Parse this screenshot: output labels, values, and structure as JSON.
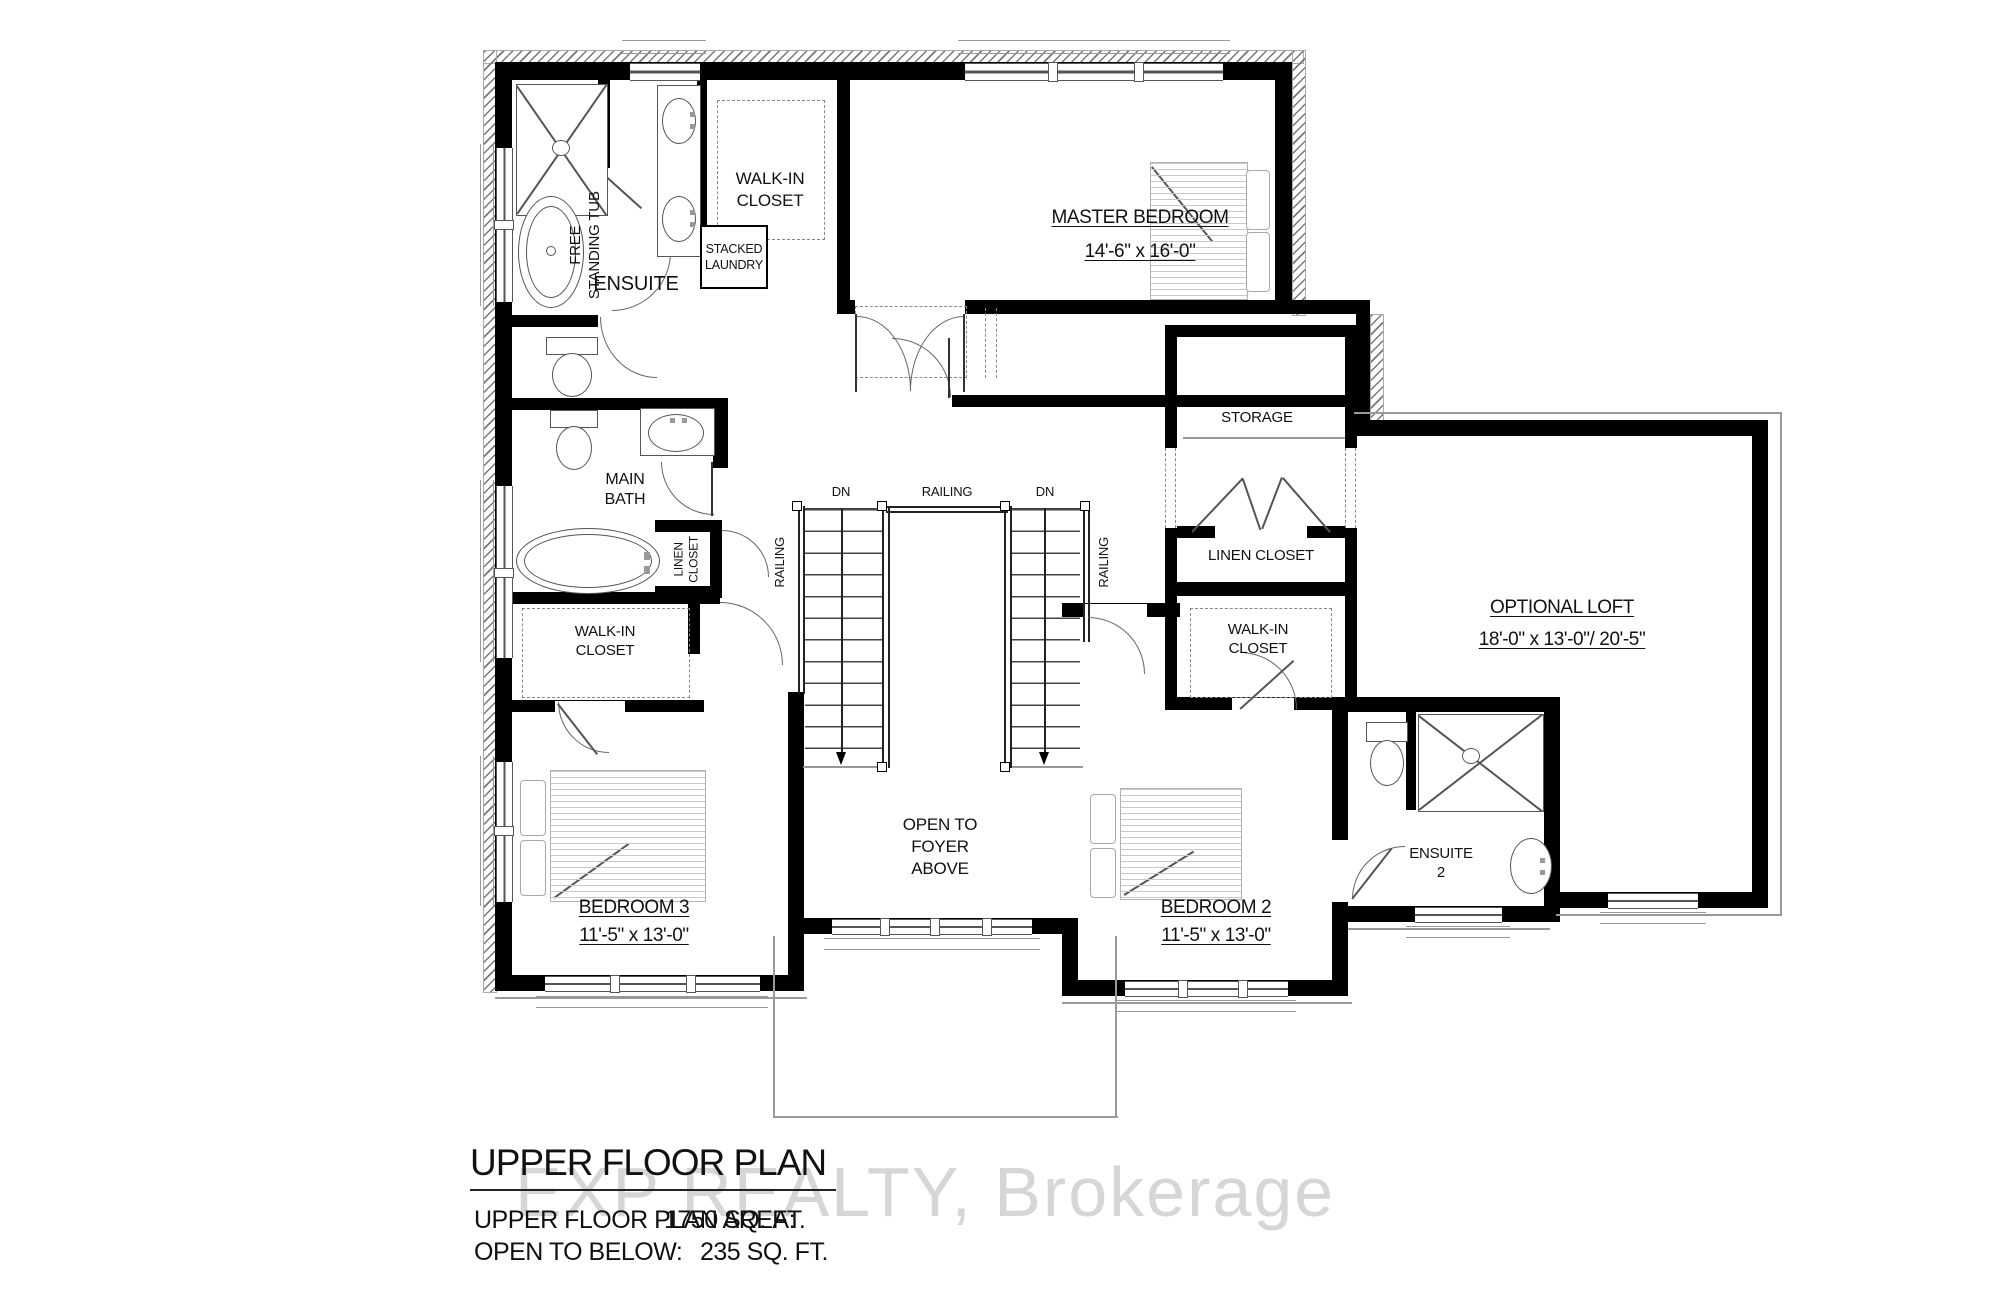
{
  "plan": {
    "rooms": {
      "ensuite": {
        "label": "ENSUITE"
      },
      "free_standing_tub": {
        "label": "FREE\nSTANDING TUB"
      },
      "walk_in_closet_master": {
        "label": "WALK-IN\nCLOSET"
      },
      "stacked_laundry": {
        "label": "STACKED\nLAUNDRY"
      },
      "master_bedroom": {
        "label": "MASTER BEDROOM",
        "dimensions": "14'-6\" x 16'-0\""
      },
      "storage": {
        "label": "STORAGE"
      },
      "linen_closet_right": {
        "label": "LINEN CLOSET"
      },
      "optional_loft": {
        "label": "OPTIONAL LOFT",
        "dimensions": "18'-0\" x 13'-0\"/ 20'-5\""
      },
      "walk_in_closet_right": {
        "label": "WALK-IN\nCLOSET"
      },
      "ensuite_2": {
        "label": "ENSUITE\n2"
      },
      "bedroom_2": {
        "label": "BEDROOM 2",
        "dimensions": "11'-5\" x 13'-0\""
      },
      "open_to_foyer": {
        "label": "OPEN TO\nFOYER\nABOVE"
      },
      "bedroom_3": {
        "label": "BEDROOM 3",
        "dimensions": "11'-5\" x 13'-0\""
      },
      "main_bath": {
        "label": "MAIN\nBATH"
      },
      "linen_closet_left": {
        "label": "LINEN\nCLOSET"
      },
      "walk_in_closet_left": {
        "label": "WALK-IN\nCLOSET"
      }
    },
    "stairs": {
      "railing_top": "RAILING",
      "railing_left": "RAILING",
      "railing_right": "RAILING",
      "dn_left": "DN",
      "dn_right": "DN"
    }
  },
  "footer": {
    "title": "UPPER FLOOR PLAN",
    "area_label": "UPPER FLOOR PLAN AREA:",
    "area_value": "1750 SQ. FT.",
    "open_below_label": "OPEN TO BELOW:",
    "open_below_value": "235 SQ. FT."
  },
  "watermark": {
    "text": "EXP REALTY, Brokerage"
  },
  "colors": {
    "wall": "#000000",
    "fixture": "#555555",
    "watermark": "#cccccc"
  }
}
